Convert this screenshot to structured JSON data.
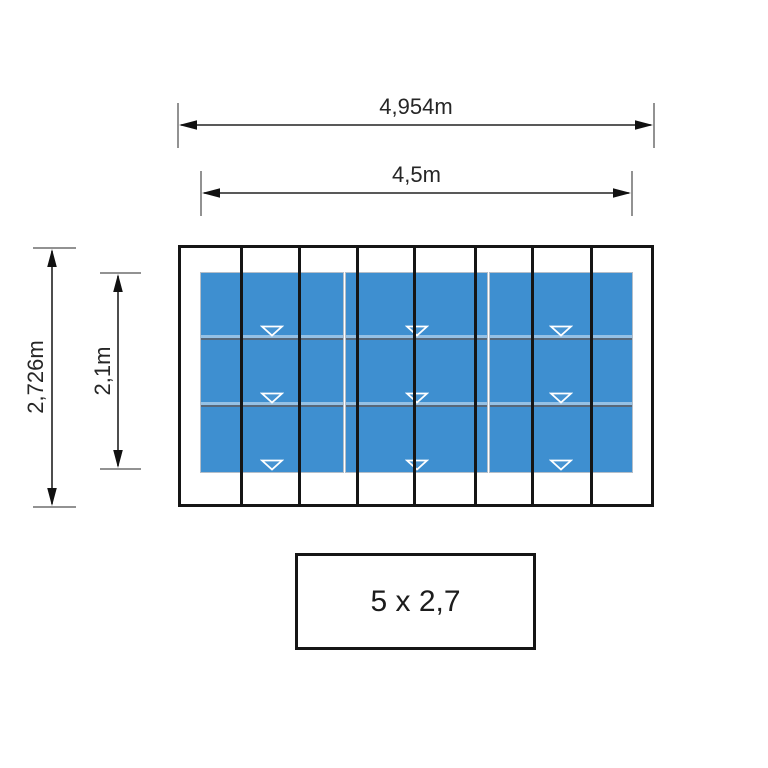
{
  "diagram": {
    "type": "technical-drawing-top-view",
    "dimensions": {
      "outer_width": "4,954m",
      "inner_width": "4,5m",
      "outer_height": "2,726m",
      "inner_height": "2,1m"
    },
    "size_label": "5 x 2,7",
    "panels": {
      "column_groups": 3,
      "rows": 3,
      "marker": "triangle-down"
    },
    "colors": {
      "panel_blue": "#3E8FD0",
      "line_black": "#151515",
      "separator_gray": "#57687a",
      "marker_white": "#ffffff"
    }
  }
}
